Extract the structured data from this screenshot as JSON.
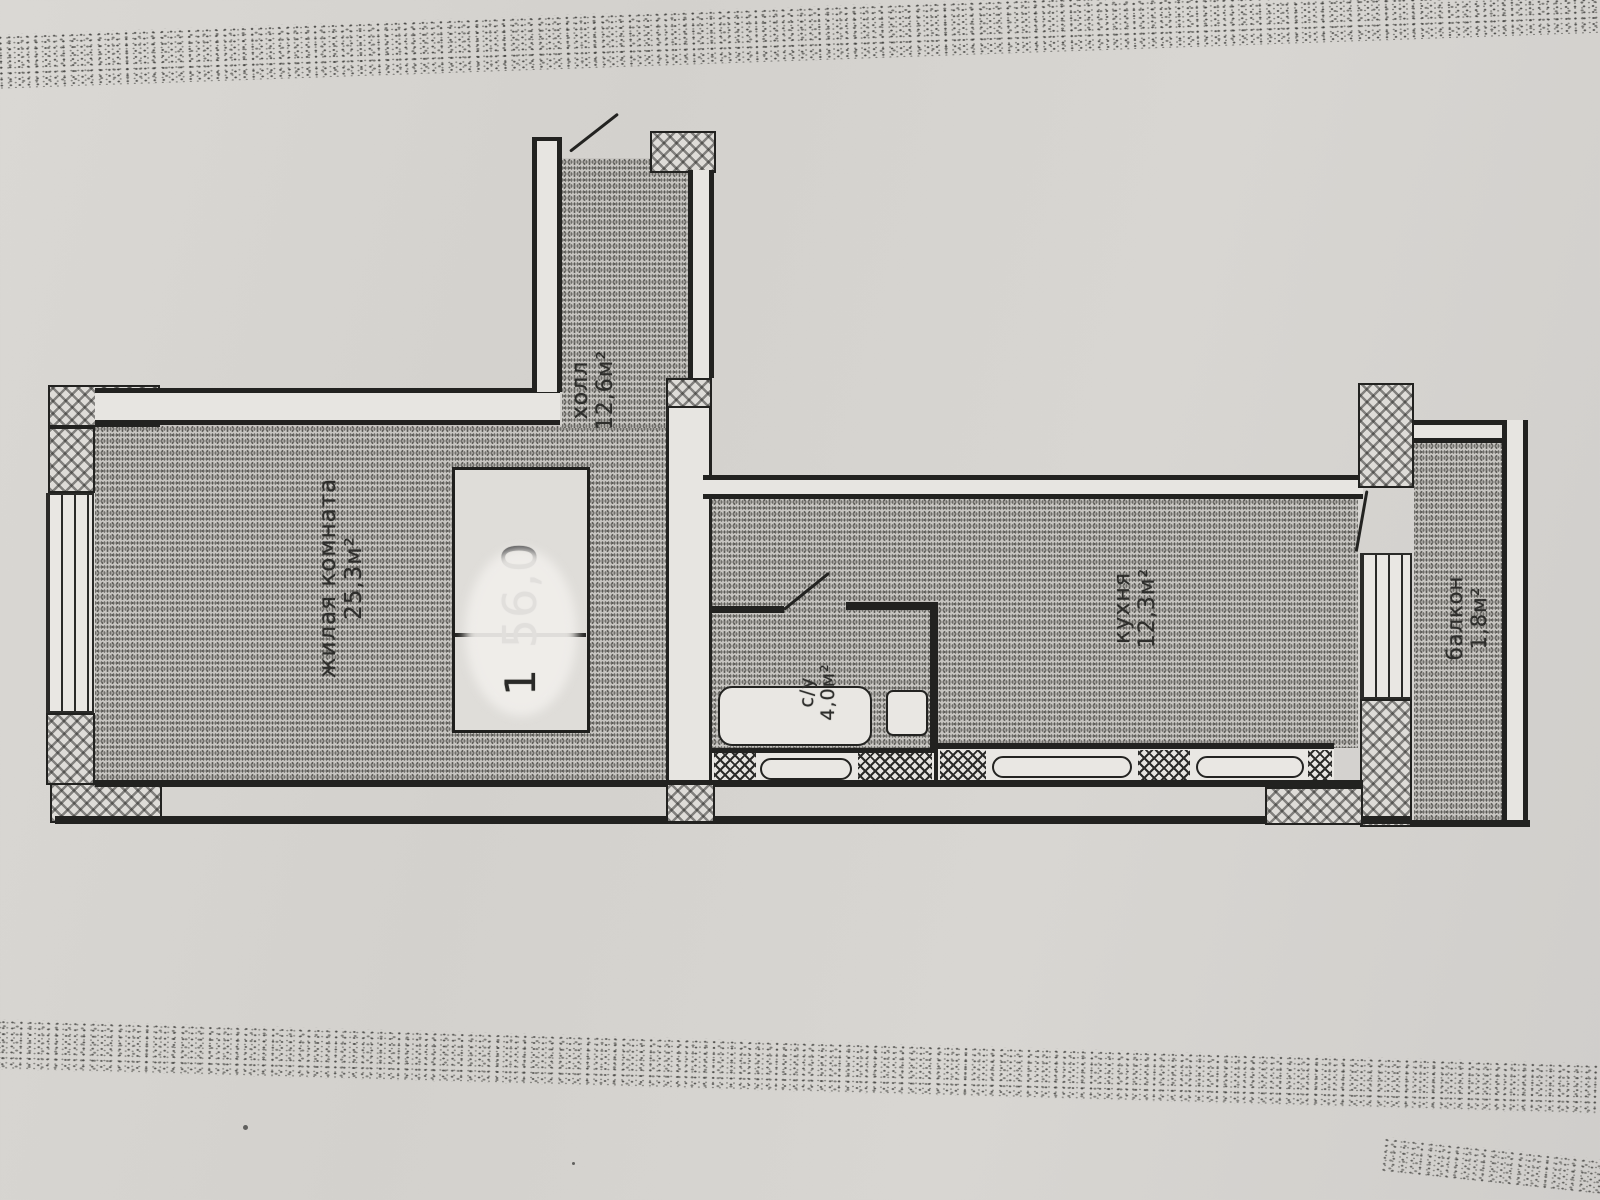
{
  "plan": {
    "rooms": [
      {
        "id": "living-room",
        "name": "жилая комната",
        "area": "25,3м²"
      },
      {
        "id": "hall",
        "name": "холл",
        "area": "12,6м²"
      },
      {
        "id": "kitchen",
        "name": "кухня",
        "area": "12,3м²"
      },
      {
        "id": "bathroom",
        "name": "с/у",
        "area": "4,0м²"
      },
      {
        "id": "balcony",
        "name": "балкон",
        "area": "1,8м²"
      }
    ],
    "stamp": {
      "total_area": "56,0",
      "apartment_number": "1"
    },
    "colors": {
      "paper": "#d6d4d0",
      "ink": "#222220",
      "floor_stipple": "#b5b3af"
    }
  }
}
